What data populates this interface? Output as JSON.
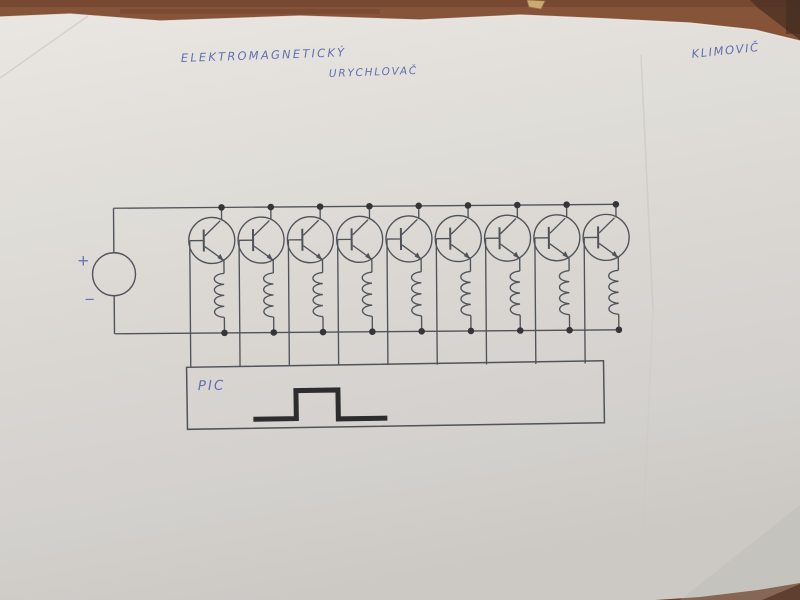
{
  "handwriting": {
    "title_line1": "ELEKTROMAGNETICKÝ",
    "title_line2": "URYCHLOVAČ",
    "author": "KLIMOVIČ"
  },
  "schematic": {
    "type": "electronic-circuit",
    "stage_count": 9,
    "source": {
      "plus_label": "+",
      "minus_label": "−"
    },
    "controller": {
      "label": "PIC",
      "waveform_icon": "square-pulse"
    }
  },
  "colors": {
    "desk": "#7b4428",
    "desk_dark": "#5a3019",
    "paper": "#d9d6d1",
    "ink": "#42464d",
    "handwriting_blue": "#5763ab",
    "pulse": "#1d1d20",
    "junction_dot": "#26262a"
  }
}
